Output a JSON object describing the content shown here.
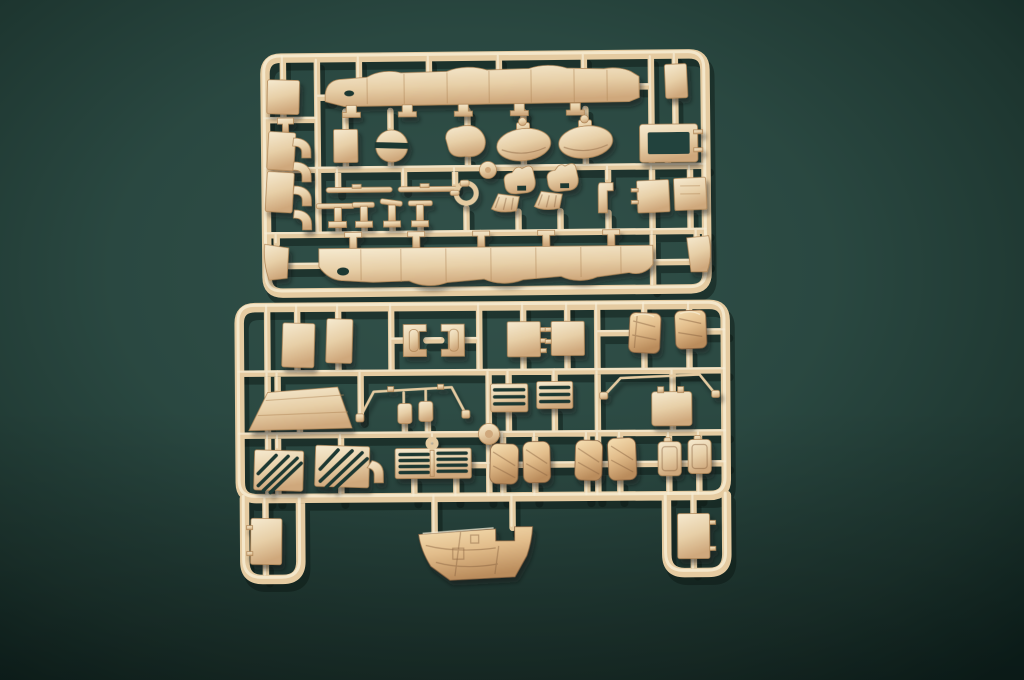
{
  "scene": {
    "type": "photograph",
    "description": "Two tan injection-molded plastic model-kit sprues with tank accessory parts lying on a dark green felt background",
    "colors": {
      "bg_mid": "#2c4a43",
      "bg_dark": "#132723",
      "plastic": "#e5cba1",
      "plastic_light": "#f7edd5",
      "plastic_dark": "#b08758",
      "plastic_deep": "#8a6442",
      "tarp": "#e2bd8b",
      "slot": "#1d3833",
      "shadow": "rgba(10,22,18,0.45)"
    },
    "sprues": [
      {
        "id": "A",
        "label": "upper sprue",
        "parts": [
          "corner access panel (top-left)",
          "stacked step brackets (x4)",
          "side skirt upper",
          "corner plate (top-right)",
          "rectangular hatch panel",
          "round split hatch",
          "gun mantlet blob",
          "turret roof oval (x2)",
          "rectangular window frame",
          "thin rod (x2)",
          "small T-brackets (x4)",
          "towing clevis ring",
          "hull fitting with pleated skirt (x2)",
          "L-bracket",
          "side panels (x2)",
          "side skirt lower",
          "mud flap left",
          "mud flap right",
          "round sprue gate"
        ]
      },
      {
        "id": "B",
        "label": "lower sprue",
        "parts": [
          "rectangular panel (x2)",
          "roller clamp (x2)",
          "square hatch panel (x2)",
          "stowage bundle wrapped (x2)",
          "windshield trapezoid panel",
          "bent wire frame left",
          "mirror housing (x2)",
          "slatted rack (x2)",
          "bent wire frame right",
          "square hatch right",
          "round sprue gate",
          "diagonal intake grille (x2)",
          "elbow pipe",
          "horizontal slat grille",
          "stowage bag (x4)",
          "jerry can (x2)",
          "door panel left extension",
          "door panel right extension",
          "large tarpaulin cover"
        ]
      }
    ]
  }
}
